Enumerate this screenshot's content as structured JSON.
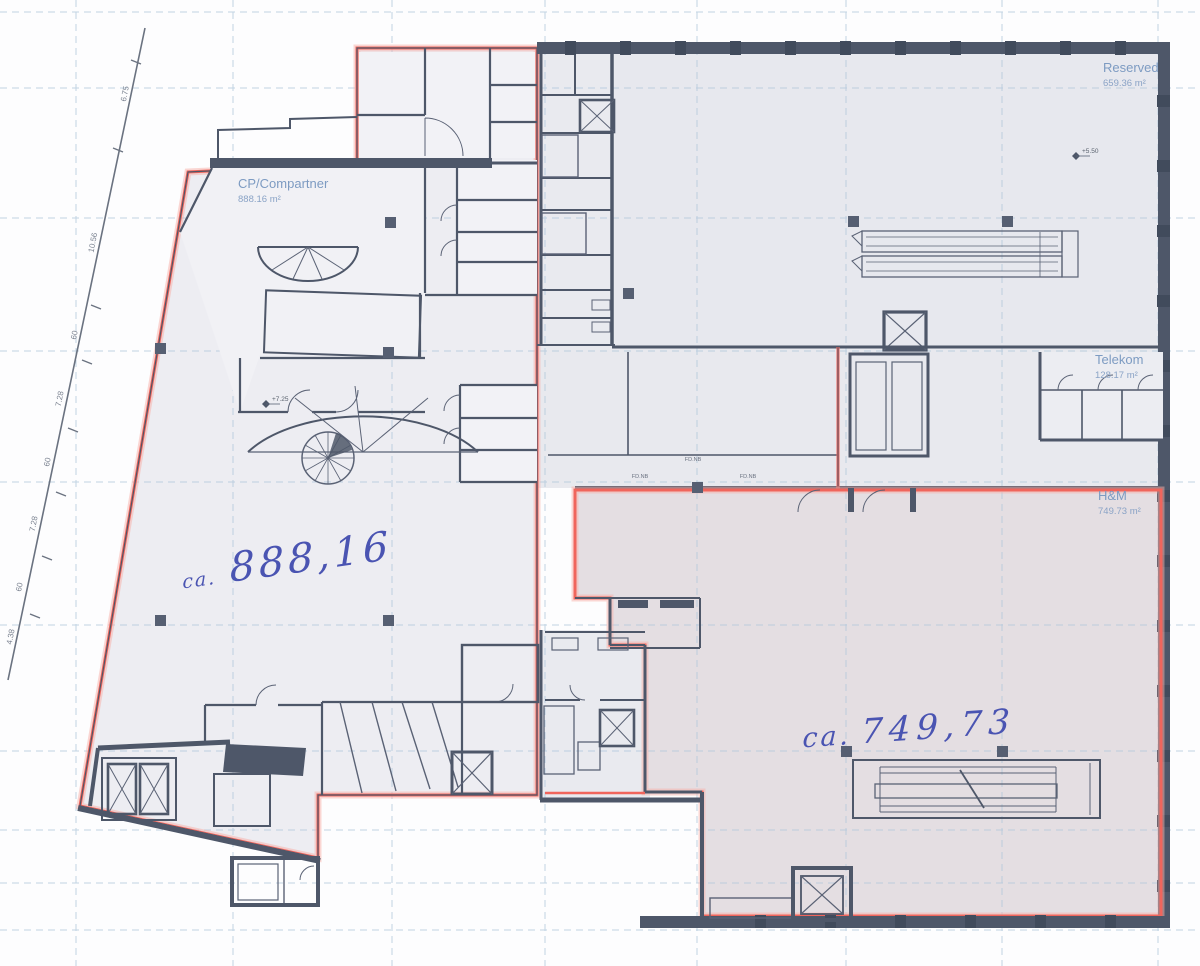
{
  "document_title": "Floor plan – tenant areas (scanned drawing)",
  "tenants": {
    "cp": {
      "name": "CP/Compartner",
      "area": "888.16 m²"
    },
    "reserved": {
      "name": "Reserved",
      "area": "659.36 m²"
    },
    "telekom": {
      "name": "Telekom",
      "area": "128.17 m²"
    },
    "hm": {
      "name": "H&M",
      "area": "749.73 m²"
    }
  },
  "handwritten": {
    "cp": {
      "prefix": "ca.",
      "value": "888,16"
    },
    "hm": {
      "prefix": "ca.",
      "value": "749,73"
    }
  },
  "boundary_dimensions": [
    "6.75",
    "10.56",
    "60",
    "7.28",
    "60",
    "7.28",
    "60",
    "4.38"
  ],
  "level_markers": {
    "cp": "+7.25",
    "reserved": "+5.50"
  },
  "wall_labels": [
    "FD.NB",
    "FD.NB",
    "FD.NB"
  ],
  "colors": {
    "red_outline": "#f0655c",
    "label_blue": "#7d9bc2",
    "ink_blue": "#4a54b2",
    "grid_blue": "#aec6db",
    "wall": "#4e5769",
    "floor_fill": "#e9eaef",
    "reserved_fill": "#e7e8ee",
    "hm_fill": "#e4dee2"
  }
}
